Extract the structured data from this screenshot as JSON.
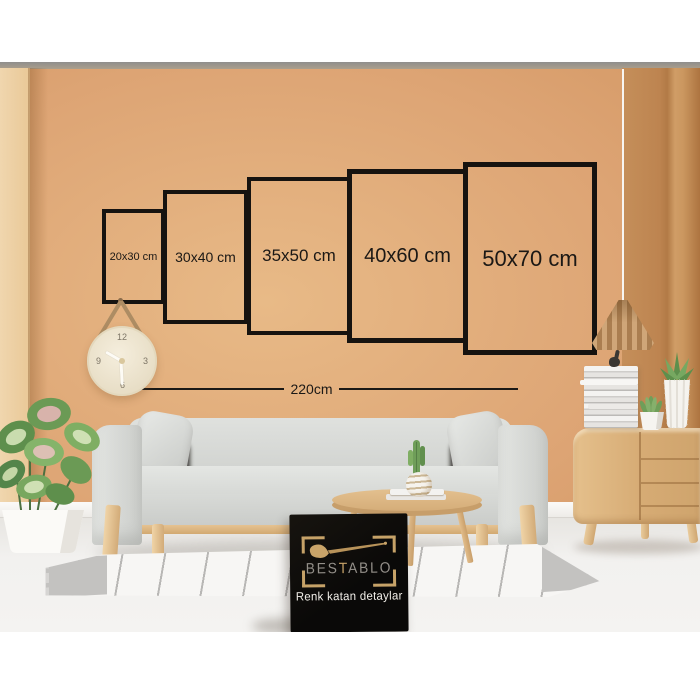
{
  "size_chart": {
    "frames": [
      {
        "id": "20x30",
        "label": "20x30 cm"
      },
      {
        "id": "30x40",
        "label": "30x40 cm"
      },
      {
        "id": "35x50",
        "label": "35x50 cm"
      },
      {
        "id": "40x60",
        "label": "40x60 cm"
      },
      {
        "id": "50x70",
        "label": "50x70 cm"
      }
    ],
    "total_width_label": "220cm"
  },
  "clock": {
    "numbers": [
      "12",
      "3",
      "6",
      "9"
    ]
  },
  "brand_card": {
    "title_parts": [
      "BES",
      "T",
      "ABLO"
    ],
    "tagline": "Renk katan detaylar",
    "icon": "paintbrush-icon"
  },
  "colors": {
    "wall": "#dda474",
    "frame_border": "#161310",
    "card_background": "#0d0c0a",
    "card_gold": "#c6a268",
    "sofa_fabric": "#d9dbd8",
    "wood": "#d6ab74",
    "floor": "#f2f1ef"
  }
}
